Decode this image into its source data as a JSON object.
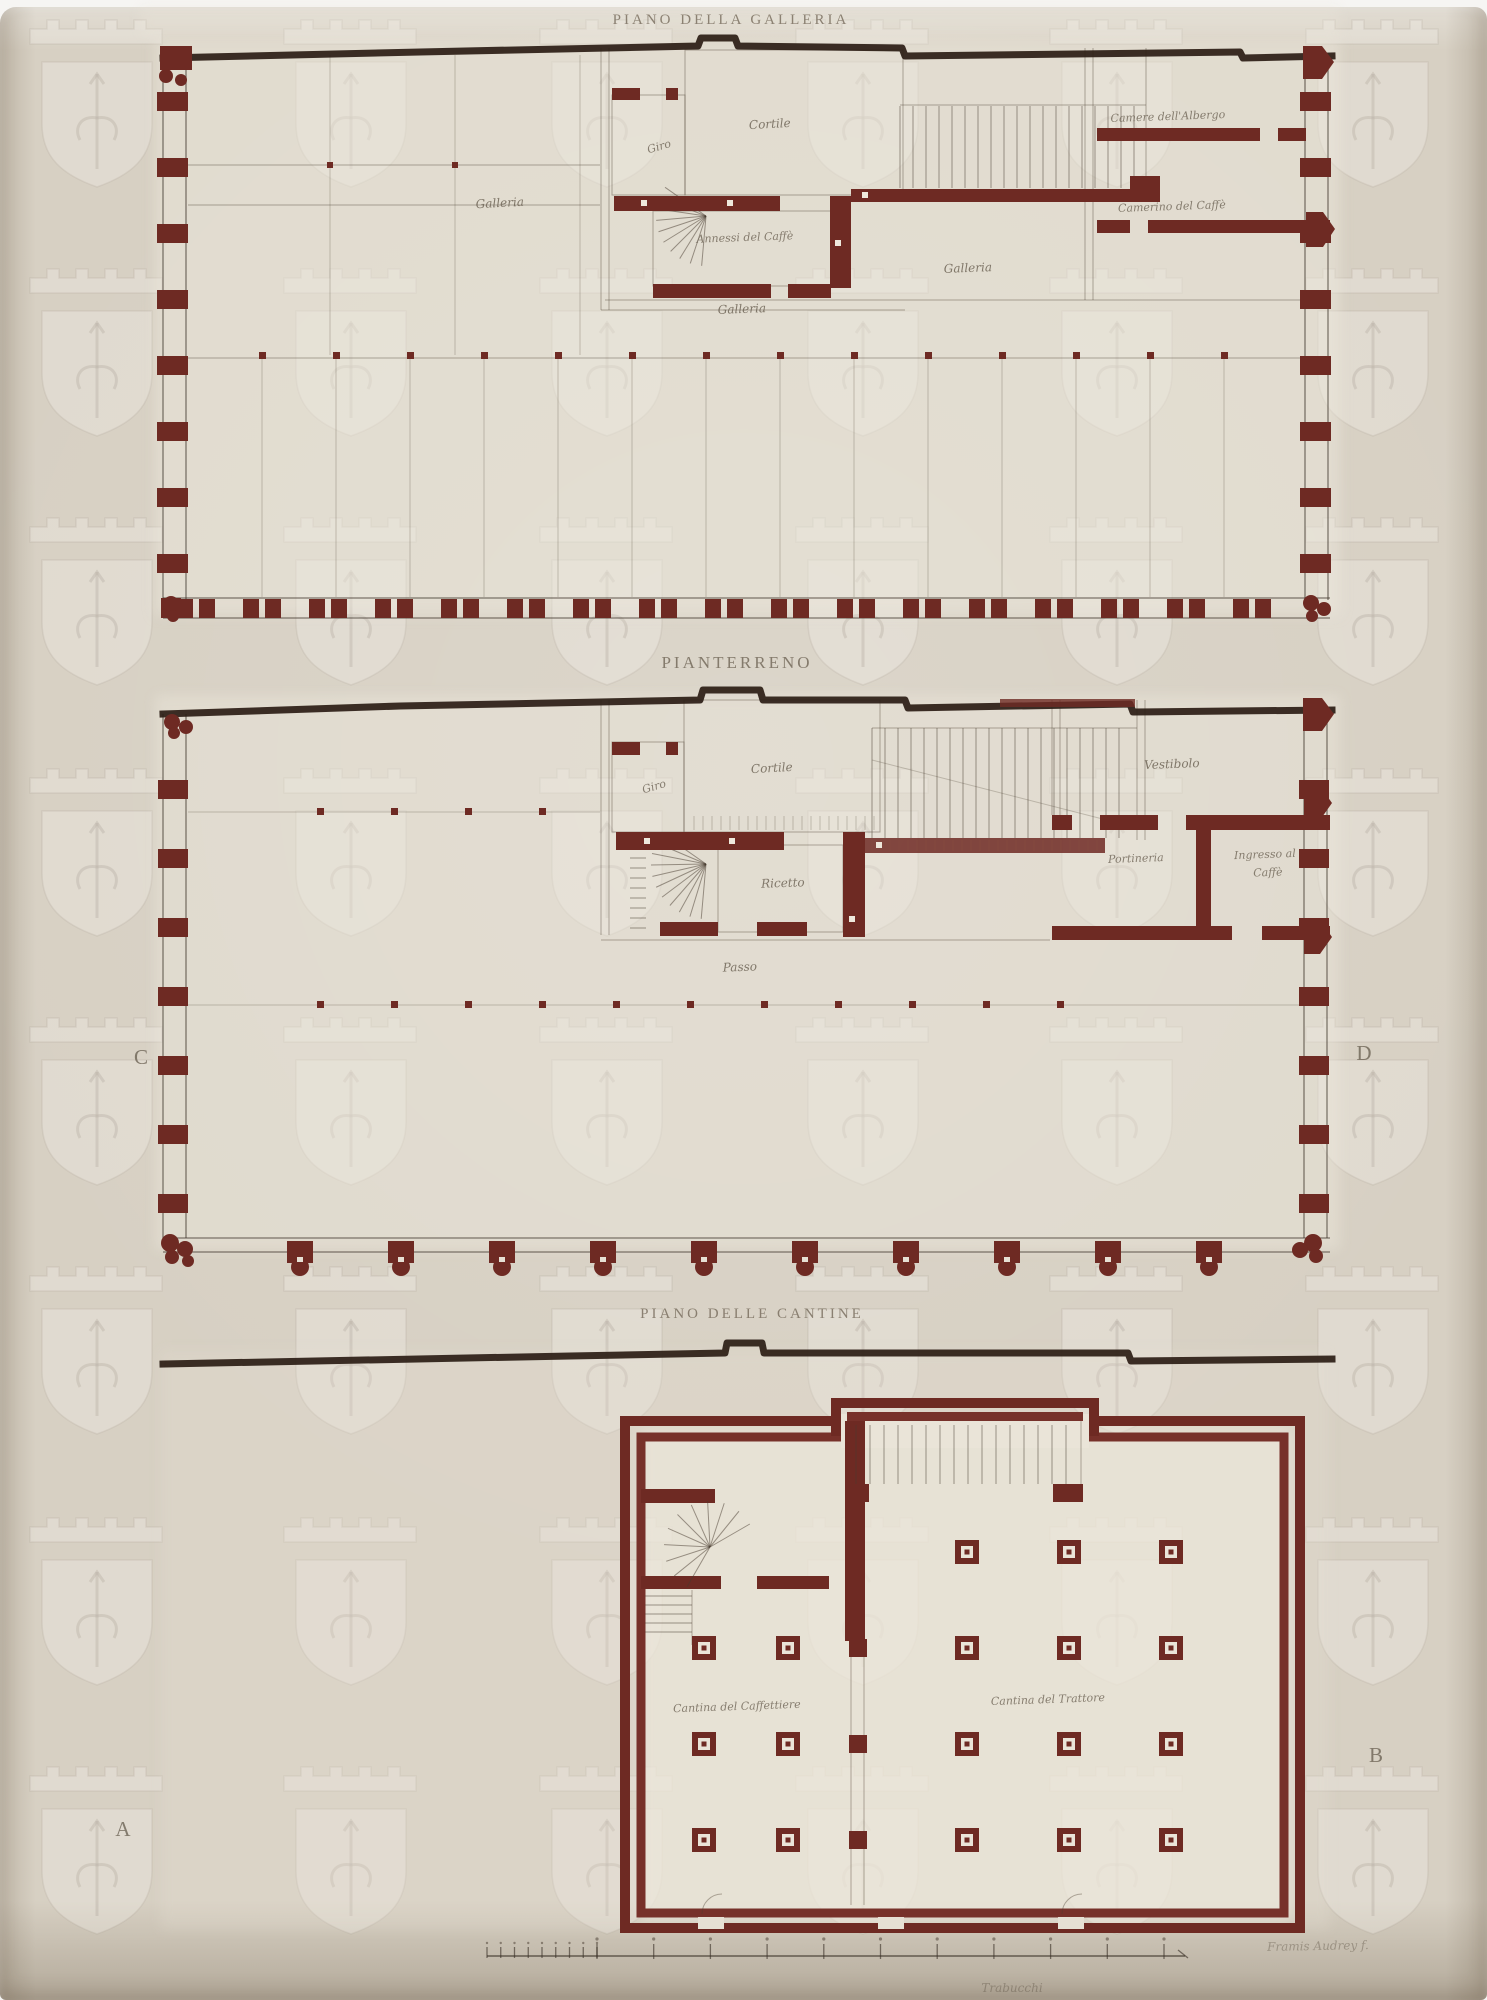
{
  "plan_galleria": {
    "title": "PIANO DELLA GALLERIA",
    "rooms": {
      "galleria_left": "Galleria",
      "giro": "Giro",
      "cortile": "Cortile",
      "annessi_caffe": "Annessi del Caffè",
      "galleria_center": "Galleria",
      "galleria_right": "Galleria",
      "camere_albergo": "Camere dell'Albergo",
      "camerino_caffe": "Camerino del Caffè"
    }
  },
  "plan_pianterreno": {
    "title": "PIANTERRENO",
    "rooms": {
      "giro": "Giro",
      "cortile": "Cortile",
      "ricetto": "Ricetto",
      "passo": "Passo",
      "vestibolo": "Vestibolo",
      "portineria": "Portineria",
      "ingresso_line1": "Ingresso al",
      "ingresso_line2": "Caffè"
    },
    "section_markers": {
      "left": "C",
      "right": "D"
    }
  },
  "plan_cantine": {
    "title": "PIANO DELLE CANTINE",
    "rooms": {
      "cantina_caffettiere": "Cantina del Caffettiere",
      "cantina_trattore": "Cantina del Trattore"
    },
    "section_markers": {
      "left": "A",
      "right": "B"
    }
  },
  "footer": {
    "scale_label": "Trabucchi",
    "signature": "Framis Audrey f."
  },
  "colors": {
    "paper": "#d7d0c3",
    "plan_paper": "#ece7db",
    "wall_ink": "#6e2a23",
    "dark_ink": "#2b1d15",
    "line_ink": "#6a5f52",
    "label_ink": "#6b6153"
  }
}
